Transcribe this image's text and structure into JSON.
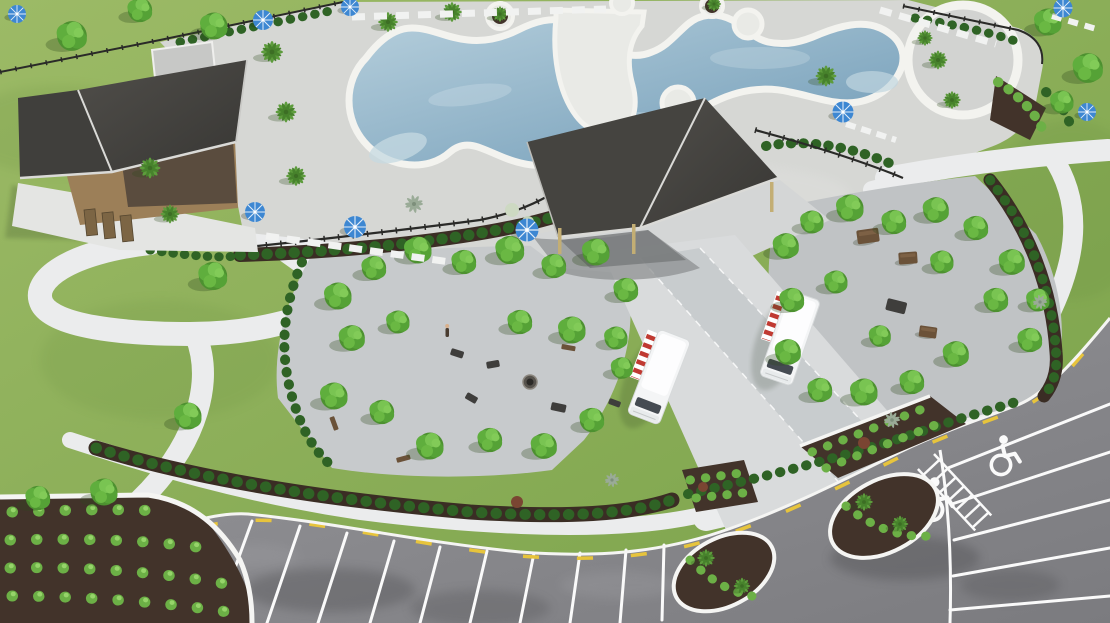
{
  "meta": {
    "title": "Aerial rendering - community amenity center",
    "media_type": "3D architectural rendering, aerial oblique view",
    "width_px": 1110,
    "height_px": 623
  },
  "scene": {
    "setting": "Resort-style community amenity area seen from above",
    "features": [
      "Freeform swimming pool with white coping, deck peninsula and circular plaza node",
      "Rows of white lounge chairs and blue patio umbrellas around pool deck",
      "Poolside cabana building with dark charcoal roof and tan walls",
      "Large open-air pavilion with dark two-panel roof on slender posts",
      "Two white food trucks with red-and-white striped awnings on a drive aisle",
      "Two paved groves of shade trees with lounge furniture, fire pit and picnic tables",
      "Curving white concrete sidewalks across green lawns",
      "Black metal pool fencing with hedge rows",
      "Asphalt parking lot with angled stalls, two accessible stalls and striped access aisle",
      "Teardrop planting islands with palms, shrub beds in dark mulch"
    ],
    "counts": {
      "food_trucks": 2,
      "pavilion_roofs": 2,
      "blue_umbrellas": 9,
      "accessible_parking_symbols": 2,
      "front_parking_stripes": 11,
      "right_parking_stripes": 5,
      "planting_islands": 2
    }
  },
  "colors": {
    "grass_light": "#9cba66",
    "grass_dark": "#7aa24a",
    "water_light": "#b6cfdc",
    "water_deep": "#6f9ab6",
    "pool_coping": "#f3f3ef",
    "deck": "#d6d7d4",
    "peninsula": "#e9eae6",
    "roof_light": "#504e4a",
    "roof_dark": "#383734",
    "roof_trim": "#dadad7",
    "wall_tan": "#9c7f58",
    "wall_dark": "#5a4c3e",
    "door": "#7c6544",
    "pavilion_post": "#c3ae74",
    "plaza_paver": "#c7cacc",
    "grove_gravel": "#c0c3c5",
    "drive": "#d9dbdc",
    "drive_paver": "#c8ccce",
    "asphalt_light": "#96969a",
    "asphalt_dark": "#7b7b7f",
    "sidewalk": "#ebeced",
    "curb": "#f5f5f3",
    "mulch": "#42332a",
    "hedge": "#2f6325",
    "shrub": "#6cb046",
    "shrub_highlight": "#96d46a",
    "tree": "#4d9130",
    "tree_highlight": "#82cb58",
    "palm": "#5d9c3c",
    "agave": "#9aab97",
    "umbrella_blue": "#3d87d2",
    "truck_body": "#f4f5f6",
    "awning_red": "#c03a32",
    "stripe_white": "#fafafa",
    "curb_yellow": "#e7c43c",
    "fence": "#2a2a28",
    "furniture_dark": "#3f3e3c",
    "furniture_brown": "#6b5239"
  }
}
